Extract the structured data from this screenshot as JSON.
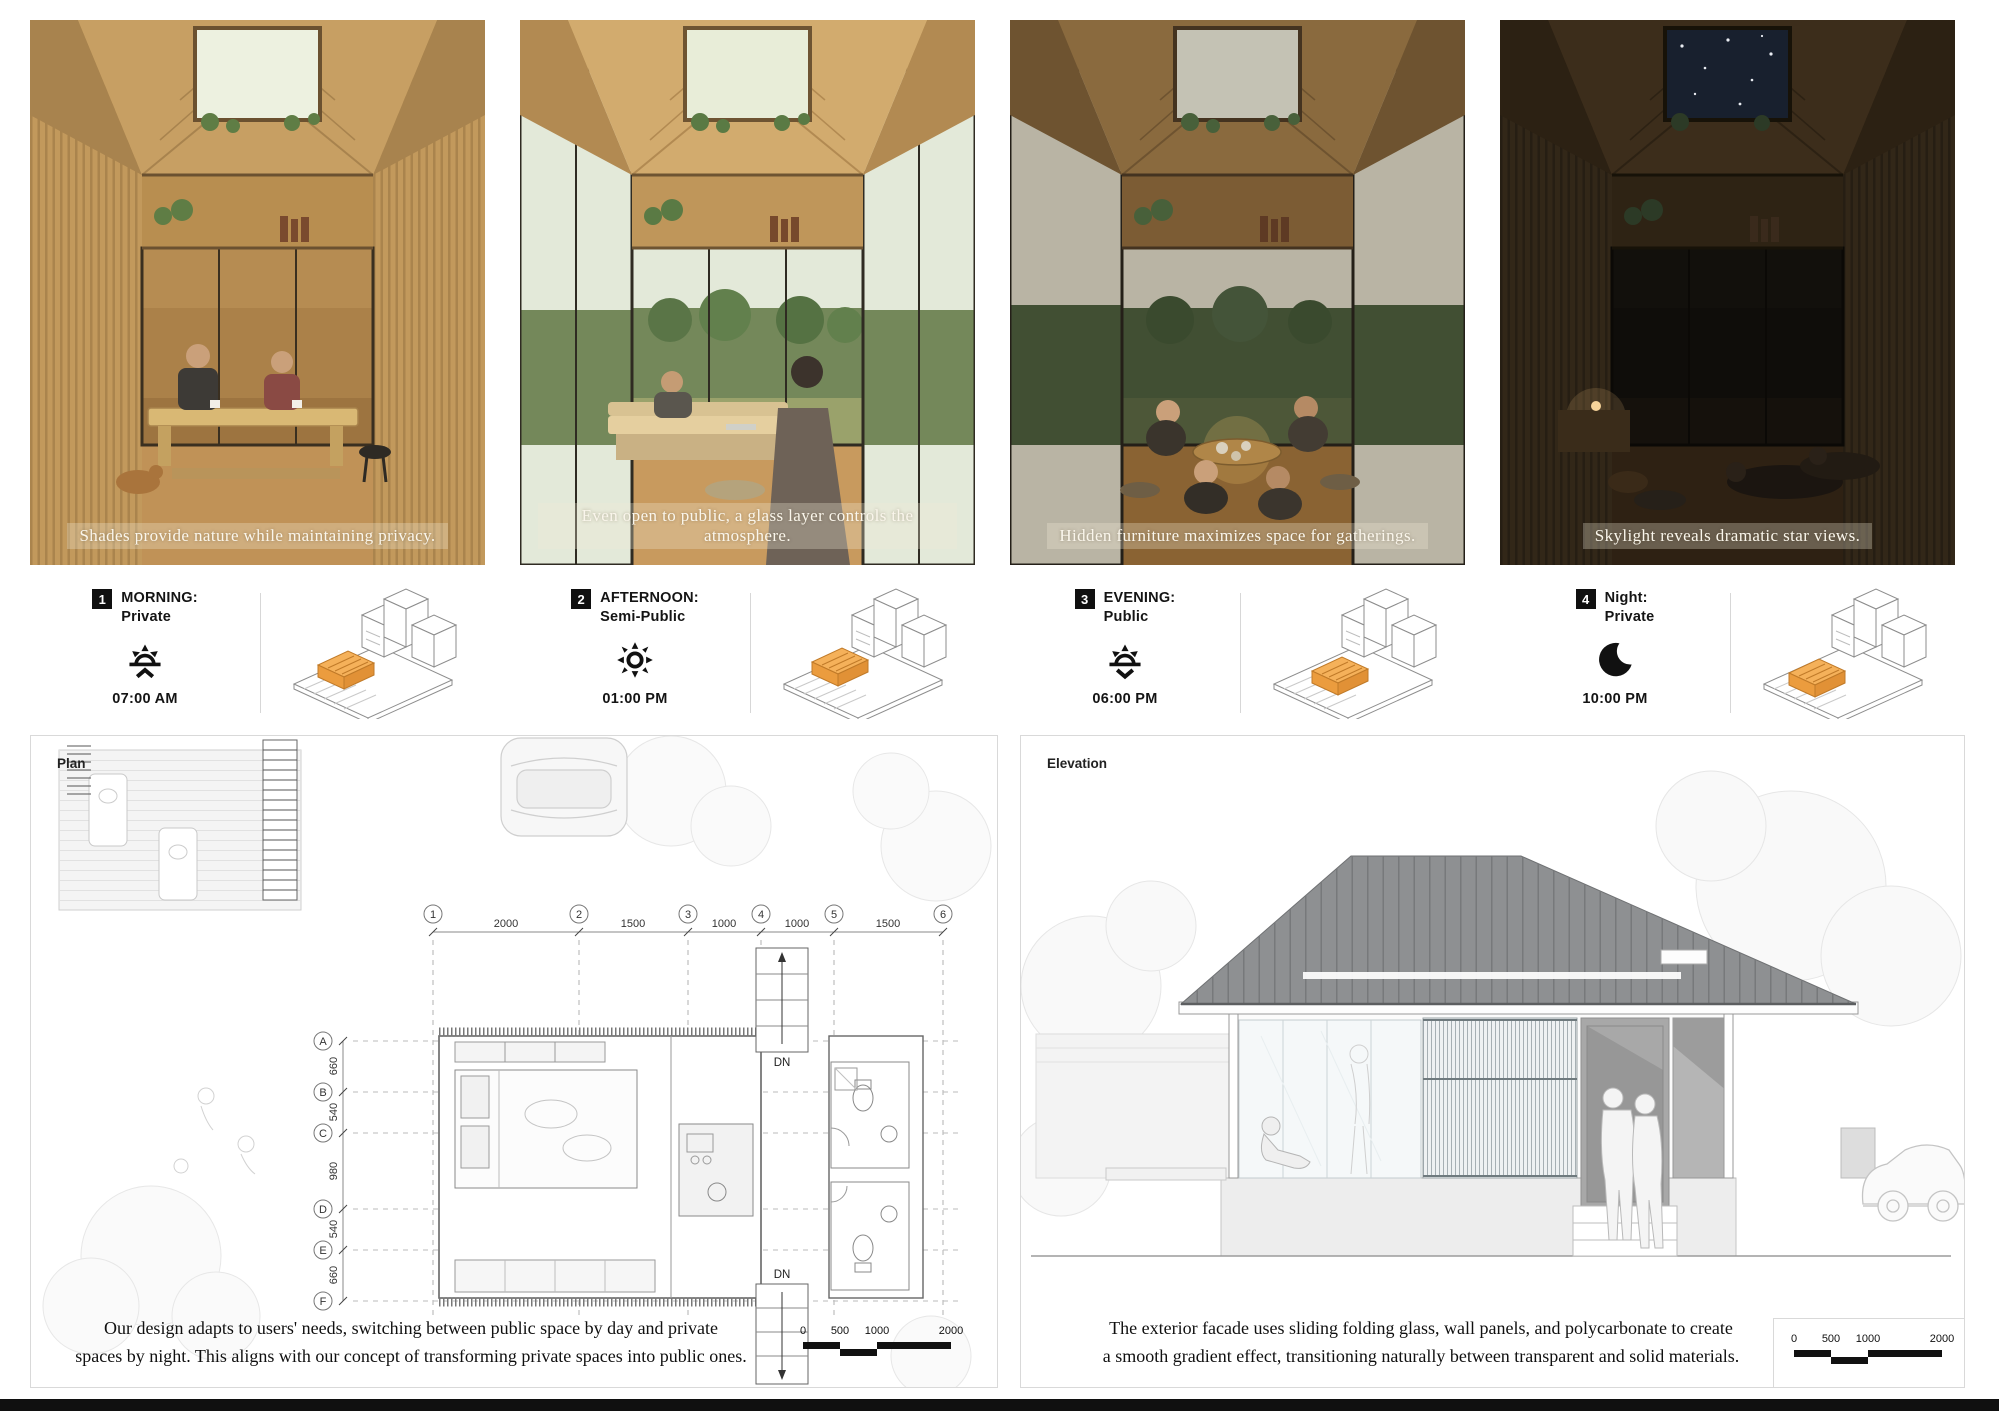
{
  "scenes": [
    {
      "number": "1",
      "title": "MORNING:",
      "subtitle": "Private",
      "icon": "sunrise-icon",
      "time": "07:00 AM",
      "caption": "Shades provide nature while maintaining privacy."
    },
    {
      "number": "2",
      "title": "AFTERNOON:",
      "subtitle": "Semi-Public",
      "icon": "sun-icon",
      "time": "01:00 PM",
      "caption": "Even open to public, a glass layer controls the atmosphere."
    },
    {
      "number": "3",
      "title": "EVENING:",
      "subtitle": "Public",
      "icon": "sunset-icon",
      "time": "06:00 PM",
      "caption": "Hidden furniture maximizes space for gatherings."
    },
    {
      "number": "4",
      "title": "Night:",
      "subtitle": "Private",
      "icon": "moon-icon",
      "time": "10:00 PM",
      "caption": "Skylight reveals dramatic star views."
    }
  ],
  "plan": {
    "label": "Plan",
    "column_labels": [
      "1",
      "2",
      "3",
      "4",
      "5",
      "6"
    ],
    "column_dims": [
      "2000",
      "1500",
      "1000",
      "1000",
      "1500"
    ],
    "row_labels": [
      "A",
      "B",
      "C",
      "D",
      "E",
      "F"
    ],
    "row_dims": [
      "660",
      "540",
      "980",
      "540",
      "660"
    ],
    "stair_label": "DN",
    "caption_line1": "Our design adapts to users' needs, switching between public space by day and private",
    "caption_line2": "spaces by night. This aligns with our concept of transforming private spaces into public ones.",
    "scale_ticks": [
      "0",
      "500",
      "1000",
      "2000"
    ]
  },
  "elevation": {
    "label": "Elevation",
    "caption_line1": "The exterior facade uses sliding folding glass, wall panels, and polycarbonate to create",
    "caption_line2": "a smooth gradient effect, transitioning naturally between transparent and solid materials.",
    "scale_ticks": [
      "0",
      "500",
      "1000",
      "2000"
    ]
  },
  "colors": {
    "accent_orange": "#f0a648",
    "footer": "#101010"
  }
}
